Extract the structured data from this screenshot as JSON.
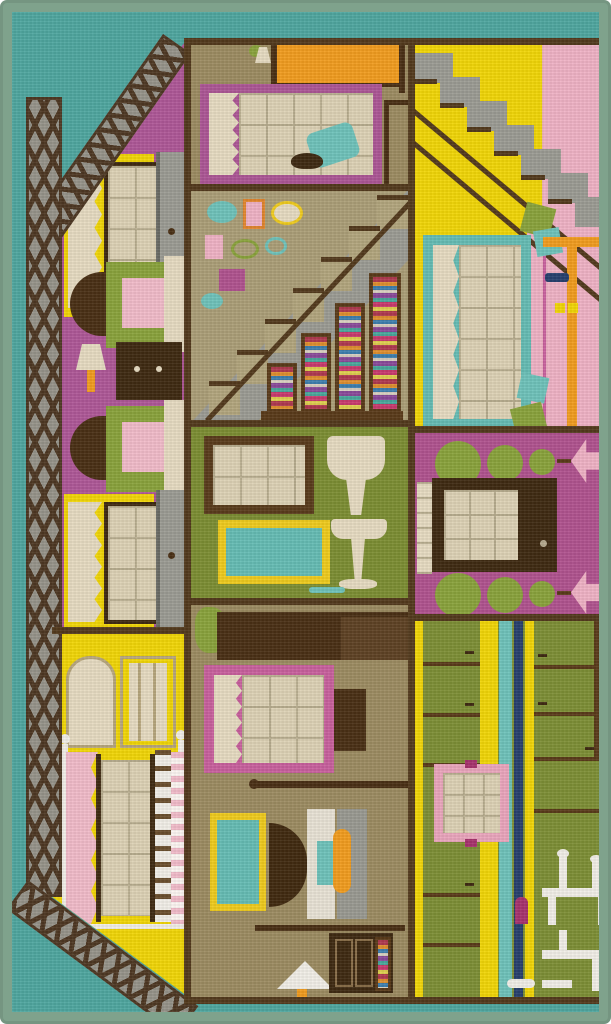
{
  "meta": {
    "subject": "children's dollhouse play rug photographed from above",
    "width_px": 611,
    "height_px": 1024
  },
  "palette": {
    "border": "#7fa28c",
    "teal_bg": "#4fa7a0",
    "lattice_brown": "#4e3823",
    "lattice_gray": "#97948a",
    "wall": "#533a1d",
    "pink_room": "#af5898",
    "yellow": "#f2d707",
    "cream": "#e7dcc2",
    "pane": "#ded3b6",
    "pane_grid": "#b9ae90",
    "khaki": "#9d8c62",
    "tan": "#ac9f78",
    "step_tan": "#b3a67e",
    "gray": "#9c9c94",
    "dark_wood": "#4a3015",
    "darker_wood": "#3f2a12",
    "olive": "#7d8e33",
    "kitchen_olive": "#7e8f36",
    "magenta": "#b1538f",
    "magenta_deep": "#a8336e",
    "light_pink": "#f0b3c6",
    "blush": "#f2bcca",
    "frame_pink": "#c9619e",
    "attic_frame": "#ad5796",
    "orange": "#f29d1f",
    "teal_accent": "#66bdb5",
    "teal_bright": "#6fc3bb",
    "navy": "#27406e",
    "topiary": "#8aa33c",
    "white": "#f2efe8",
    "gold": "#f0cc1e",
    "wall_tan": "#8a6f4a"
  },
  "structure": {
    "edge": "sage green serged rug border",
    "background": "teal ground",
    "roof": "brown lattice roof and wall bands on the left side"
  },
  "rooms": {
    "pink_bedroom": {
      "name": "pink bedroom wall with two yellow windows, grey dressers, two armchairs, lamp and nightstand"
    },
    "yellow_bedroom": {
      "name": "yellow bedroom with wardrobe outline and canopy bed with striped blanket"
    },
    "attic": {
      "name": "khaki attic bedroom with orange bed, framed window, teal chair and desk"
    },
    "stair_hall": {
      "name": "tan stair hall with gallery picture wall, diagonal staircase and under-stair book shelves"
    },
    "bathroom": {
      "name": "olive bathroom with framed window, teal mirror and cream pedestal fixtures"
    },
    "dressing_room": {
      "name": "tan dressing room with plant, window, vanity, teal mirror, lamp and book dresser"
    },
    "upper_landing": {
      "name": "yellow landing with grey staircase, big teal window and pink dining nook"
    },
    "entry": {
      "name": "magenta entry hall with dark front door and rows of round topiary bushes"
    },
    "kitchen": {
      "name": "green kitchen with cabinet panels, striped wallpaper, pink window and white dinette silhouette"
    }
  }
}
